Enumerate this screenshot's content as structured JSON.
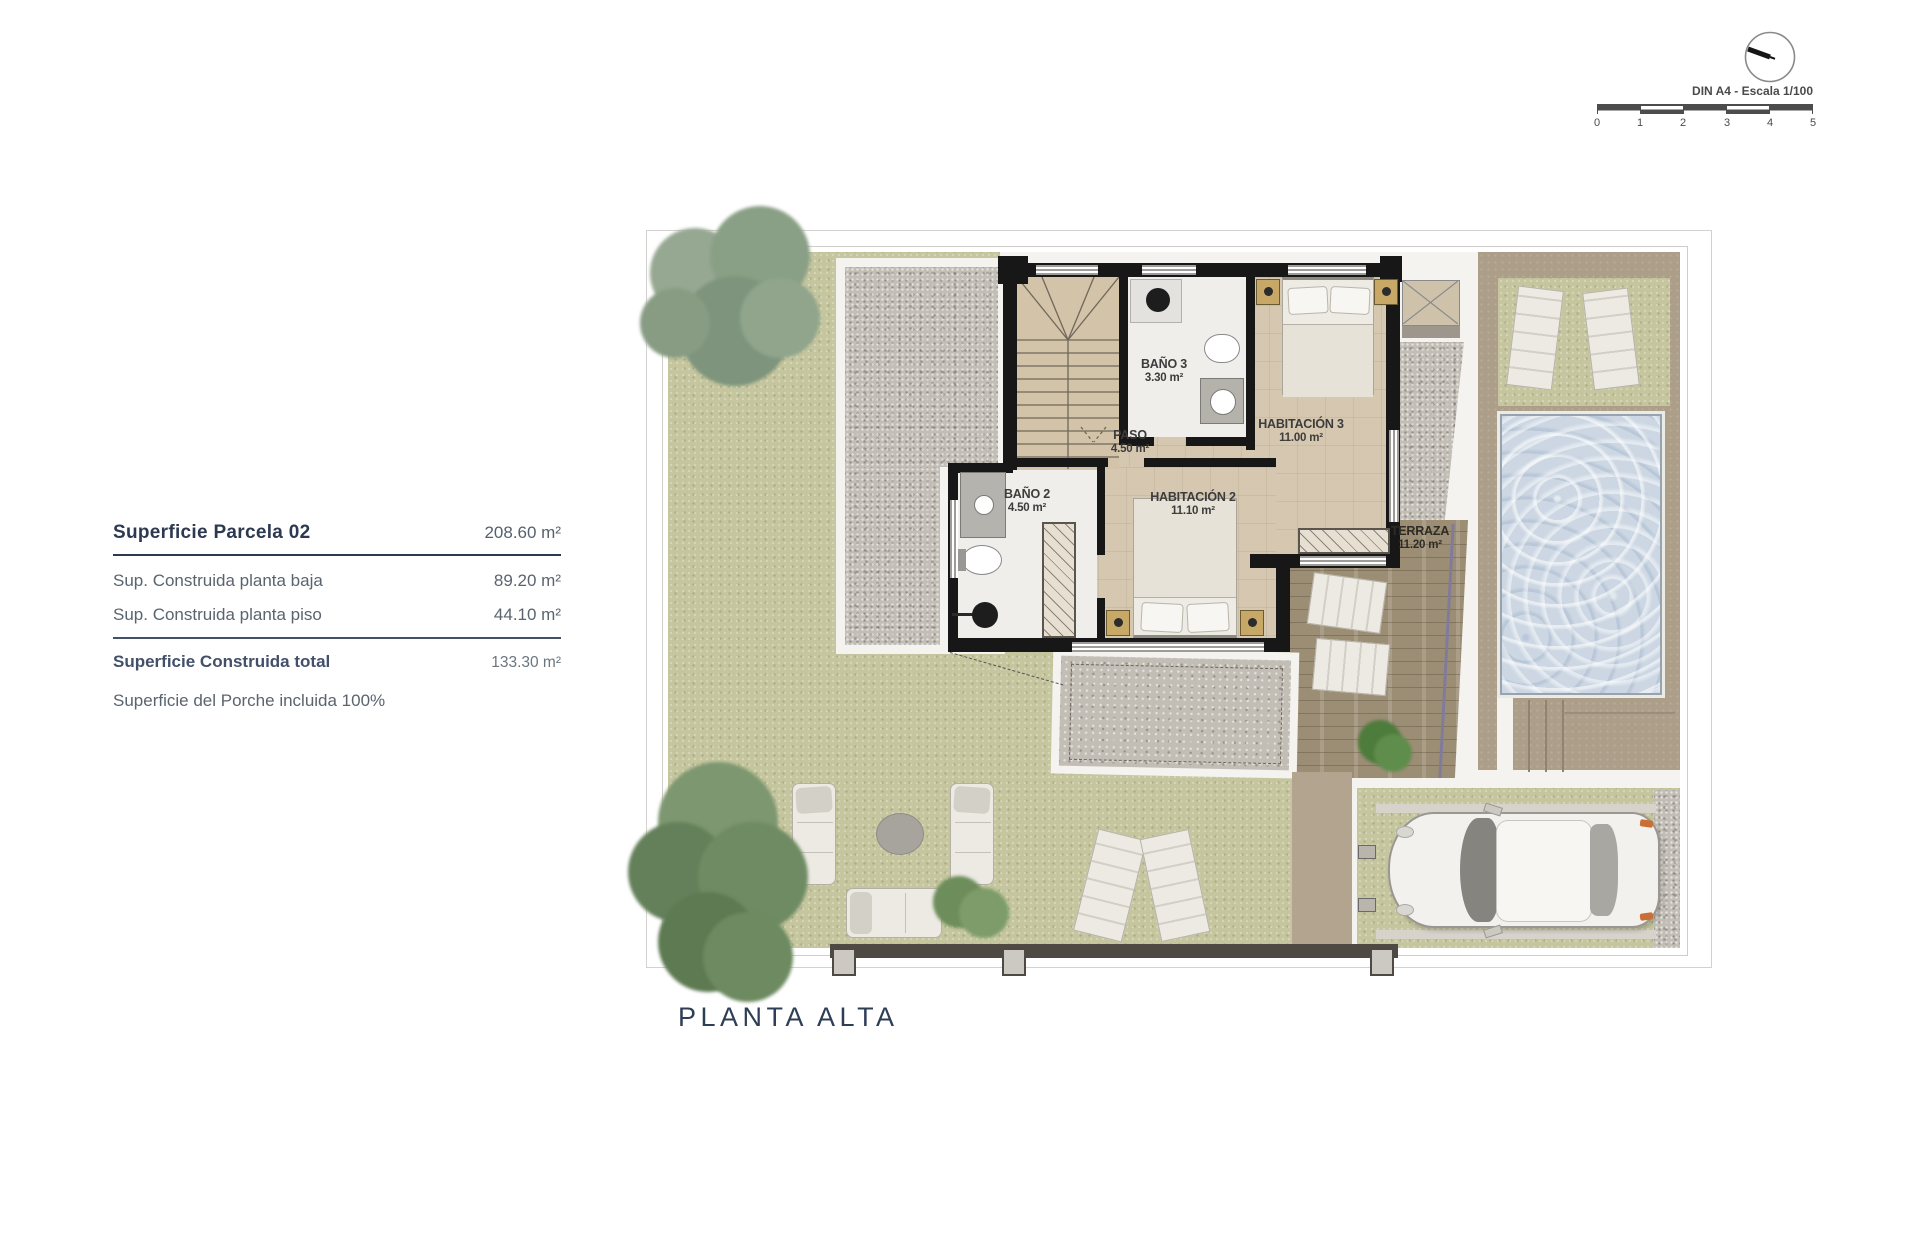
{
  "document": {
    "plan_title": "PLANTA ALTA",
    "drawing_type": "upper-floor plan"
  },
  "scale_bar": {
    "label": "DIN A4 - Escala 1/100",
    "ticks": [
      "0",
      "1",
      "2",
      "3",
      "4",
      "5"
    ]
  },
  "area_table": {
    "header_label": "Superficie Parcela 02",
    "header_value": "208.60 m²",
    "rows": [
      {
        "label": "Sup. Construida planta baja",
        "value": "89.20 m²"
      },
      {
        "label": "Sup. Construida planta piso",
        "value": "44.10 m²"
      }
    ],
    "total_label": "Superficie Construida total",
    "total_value": "133.30 m²",
    "footnote": "Superficie del Porche incluida 100%"
  },
  "rooms": [
    {
      "name": "BAÑO 3",
      "area": "3.30 m²"
    },
    {
      "name": "PASO",
      "area": "4.50 m²"
    },
    {
      "name": "HABITACIÓN 3",
      "area": "11.00 m²"
    },
    {
      "name": "BAÑO 2",
      "area": "4.50 m²"
    },
    {
      "name": "HABITACIÓN 2",
      "area": "11.10 m²"
    },
    {
      "name": "TERRAZA",
      "area": "11.20 m²"
    }
  ],
  "colors": {
    "grass": "#c5c69e",
    "gravel": "#c3beb5",
    "floor_tile": "#d6c8b0",
    "bath_floor": "#efeeea",
    "wall": "#171717",
    "terrace_deck": "#9c8e75",
    "pool_water": "#ccd7e3",
    "pool_deck": "#ac9e89",
    "heading_text": "#2c3950",
    "body_text": "#5a646f",
    "plan_label_text": "#3c3c3c"
  }
}
